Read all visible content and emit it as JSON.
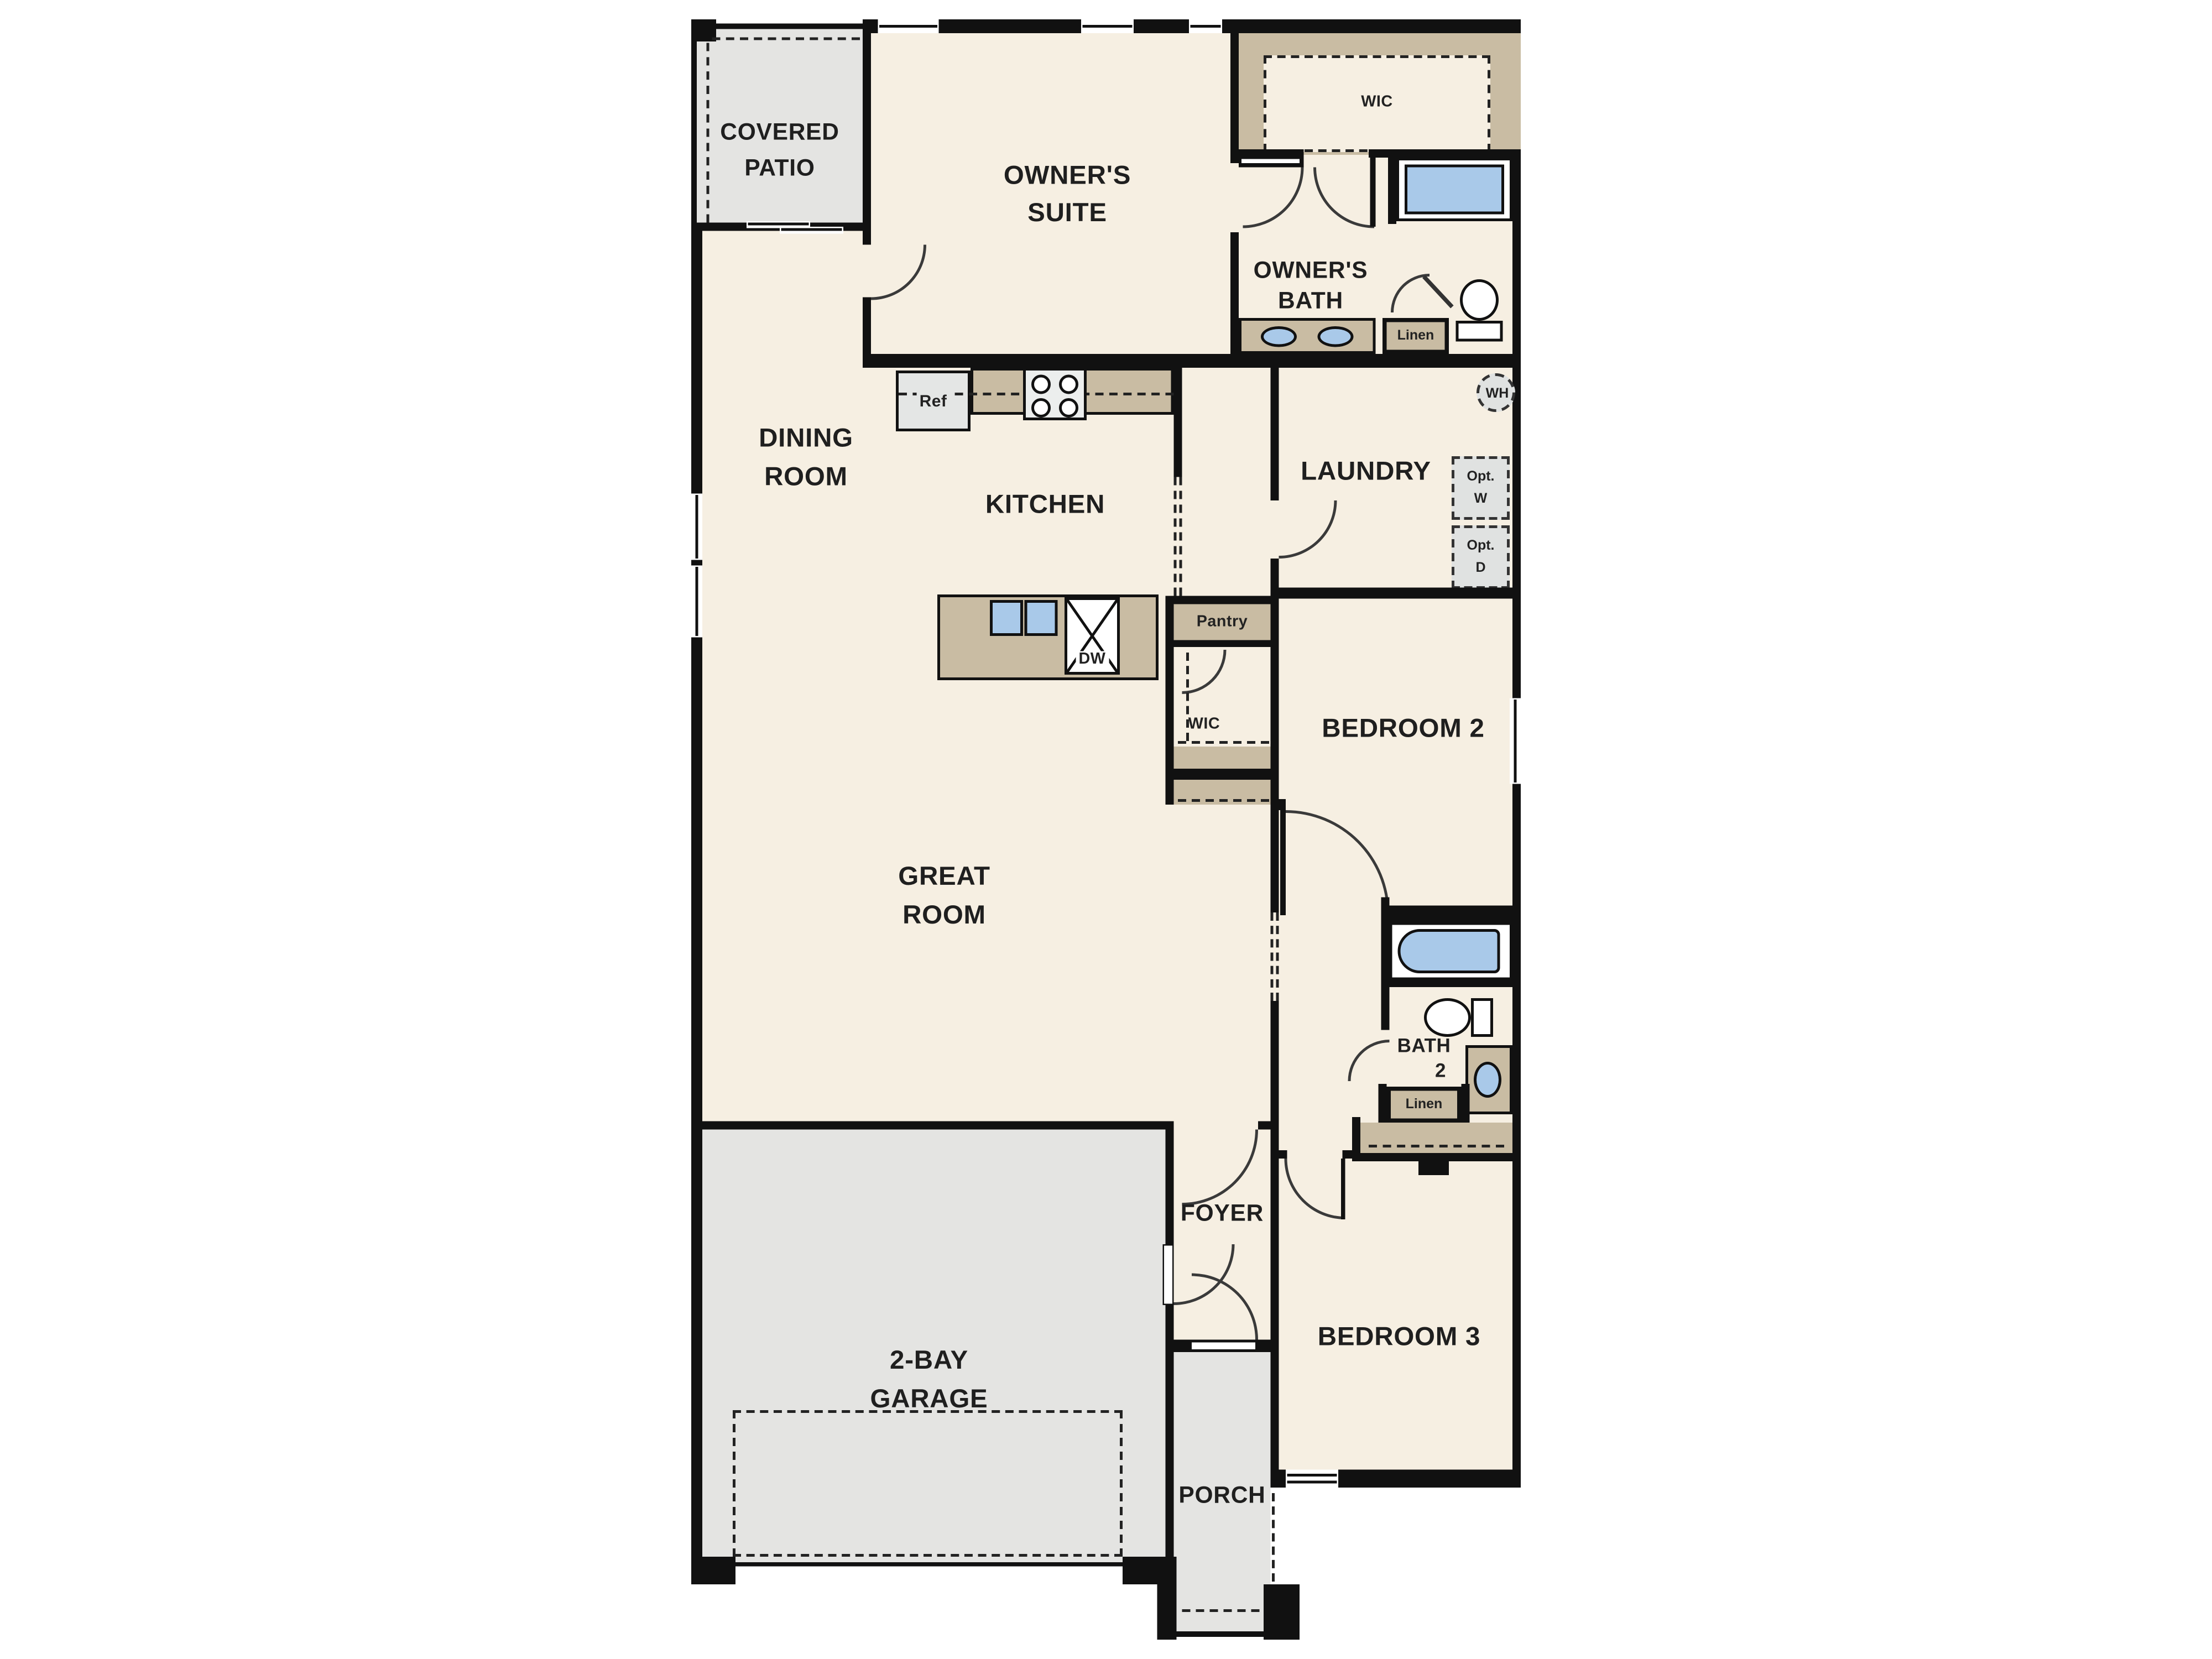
{
  "plan": {
    "title": "single-story floor plan",
    "colors": {
      "floor": "#f6efe2",
      "outdoor": "#e4e4e2",
      "closet_tan": "#c9bca3",
      "fixture_blue": "#a9c9e9",
      "wall": "#111111",
      "appliance_gray": "#e0e2e1",
      "text": "#1f1f1f"
    },
    "rooms": {
      "covered_patio": {
        "line1": "COVERED",
        "line2": "PATIO"
      },
      "owners_suite": {
        "line1": "OWNER'S",
        "line2": "SUITE"
      },
      "wic_owner": {
        "label": "WIC"
      },
      "owners_bath": {
        "line1": "OWNER'S",
        "line2": "BATH"
      },
      "dining": {
        "line1": "DINING",
        "line2": "ROOM"
      },
      "kitchen": {
        "label": "KITCHEN"
      },
      "laundry": {
        "label": "LAUNDRY"
      },
      "pantry": {
        "label": "Pantry"
      },
      "wic_hall": {
        "label": "WIC"
      },
      "bedroom2": {
        "label": "BEDROOM 2"
      },
      "great_room": {
        "line1": "GREAT",
        "line2": "ROOM"
      },
      "bath2": {
        "line1": "BATH",
        "line2": "2"
      },
      "foyer": {
        "label": "FOYER"
      },
      "bedroom3": {
        "label": "BEDROOM 3"
      },
      "garage": {
        "line1": "2-BAY",
        "line2": "GARAGE"
      },
      "porch": {
        "label": "PORCH"
      }
    },
    "fixtures": {
      "ref": "Ref",
      "dw": "DW",
      "wh": "WH",
      "linen_owner": "Linen",
      "linen_bath2": "Linen",
      "opt_w_line1": "Opt.",
      "opt_w_line2": "W",
      "opt_d_line1": "Opt.",
      "opt_d_line2": "D"
    }
  }
}
